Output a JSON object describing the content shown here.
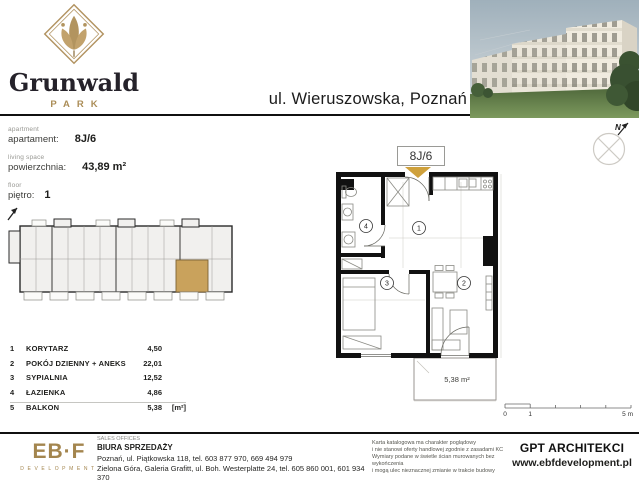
{
  "colors": {
    "gold": "#ab8d57",
    "unit_highlight": "#c9a25c",
    "arrow": "#cfa13c",
    "wall": "#111111"
  },
  "header": {
    "brand_name": "Grunwald",
    "brand_sub": "PARK",
    "address": "ul. Wieruszowska,  Poznań"
  },
  "info": {
    "fields": [
      {
        "en": "apartment",
        "pl": "apartament:",
        "value": "8J/6"
      },
      {
        "en": "living space",
        "pl": "powierzchnia:",
        "value": "43,89 m²"
      },
      {
        "en": "floor",
        "pl": "piętro:",
        "value": "1"
      }
    ]
  },
  "plan": {
    "unit_label": "8J/6",
    "balcony_area": "5,38 m²",
    "compass_label": "N",
    "scale": {
      "t0": "0",
      "t1": "1",
      "t5": "5 m"
    }
  },
  "rooms": [
    {
      "no": "1",
      "name": "KORYTARZ",
      "area": "4,50",
      "unit": ""
    },
    {
      "no": "2",
      "name": "POKÓJ DZIENNY + ANEKS",
      "area": "22,01",
      "unit": ""
    },
    {
      "no": "3",
      "name": "SYPIALNIA",
      "area": "12,52",
      "unit": ""
    },
    {
      "no": "4",
      "name": "ŁAZIENKA",
      "area": "4,86",
      "unit": ""
    },
    {
      "no": "5",
      "name": "BALKON",
      "area": "5,38",
      "unit": "[m²]"
    }
  ],
  "footer": {
    "dev_logo": "EB·F",
    "dev_sub": "DEVELOPMENT",
    "sales_en": "SALES OFFICES",
    "sales_pl": "BIURA SPRZEDAŻY",
    "address1": "Poznań, ul. Piątkowska 118, tel. 603 877 970, 669 494 979",
    "address2": "Zielona Góra, Galeria Grafitt, ul. Boh. Westerplatte 24, tel. 605 860 001, 601 934 370",
    "disclaimer": [
      "Karta katalogowa ma charakter poglądowy",
      "i nie stanowi oferty handlowej zgodnie z zasadami KC",
      "Wymiary podane w świetle ścian murowanych bez wykończenia",
      "i mogą ulec nieznacznej zmianie w trakcie budowy"
    ],
    "architect": "GPT ARCHITEKCI",
    "website": "www.ebfdevelopment.pl"
  }
}
